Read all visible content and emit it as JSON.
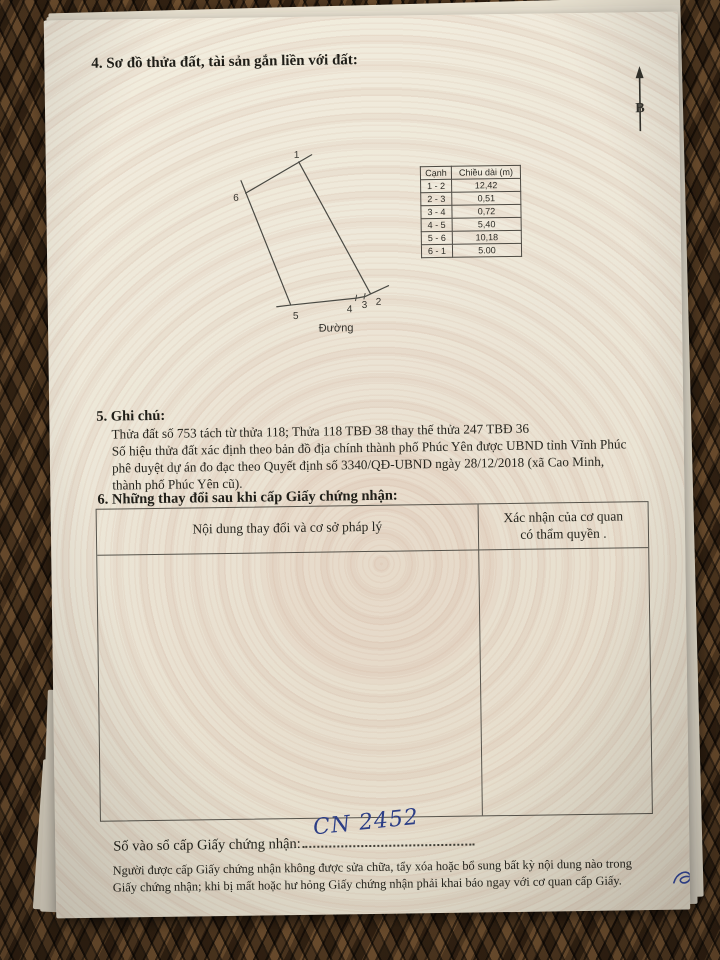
{
  "doc": {
    "section4_title": "4. Sơ đồ thửa đất, tài sản gắn liền với đất:",
    "compass_label": "B",
    "diagram": {
      "road_label": "Đường",
      "vertex_labels": [
        "1",
        "2",
        "3",
        "4",
        "5",
        "6"
      ]
    },
    "edge_table": {
      "headers": [
        "Cạnh",
        "Chiều dài (m)"
      ],
      "rows": [
        [
          "1 - 2",
          "12,42"
        ],
        [
          "2 - 3",
          "0,51"
        ],
        [
          "3 - 4",
          "0,72"
        ],
        [
          "4 - 5",
          "5,40"
        ],
        [
          "5 - 6",
          "10,18"
        ],
        [
          "6 - 1",
          "5.00"
        ]
      ]
    },
    "section5_title": "5. Ghi chú:",
    "notes": [
      "Thửa đất số 753 tách từ thửa 118; Thửa 118 TBĐ 38 thay thế thửa 247 TBĐ 36",
      "Số hiệu thửa đất xác định theo bản đồ địa chính thành phố Phúc Yên được UBND tỉnh Vĩnh Phúc",
      "phê duyệt dự án đo đạc theo Quyết định số 3340/QĐ-UBND ngày 28/12/2018 (xã Cao Minh,",
      "thành phố Phúc Yên cũ)."
    ],
    "section6_title": "6. Những thay đổi sau khi cấp Giấy chứng nhận:",
    "changes_table": {
      "col1": "Nội dung thay đổi và cơ sở pháp lý",
      "col2_line1": "Xác nhận của cơ quan",
      "col2_line2": "có thẩm quyền ."
    },
    "registry_label": "Số vào sổ cấp Giấy chứng nhận:",
    "registry_number": "CN 2452",
    "footer_lines": [
      "Người được cấp Giấy chứng nhận không được sửa chữa, tẩy xóa hoặc bổ sung bất kỳ nội dung nào trong",
      "Giấy chứng nhận; khi bị mất hoặc hư hỏng Giấy chứng nhận phải khai báo ngay với cơ quan cấp Giấy."
    ]
  },
  "colors": {
    "ink": "#26251e",
    "handwriting_blue": "#2c3e86",
    "paper": "#ece6d7",
    "wicker_brown": "#2f2012",
    "table_border": "#57544c"
  }
}
